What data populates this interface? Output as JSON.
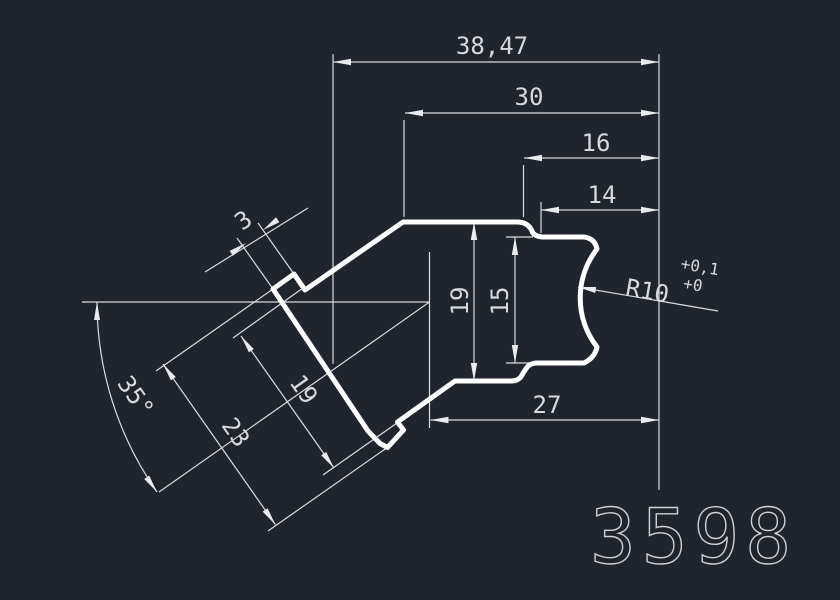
{
  "drawing": {
    "part_number": "3598",
    "dimensions": {
      "overall_width": "38,47",
      "upper_width": "30",
      "step_width_16": "16",
      "step_width_14": "14",
      "lower_width": "27",
      "height_total": "19",
      "height_inner": "15",
      "arm_length_19": "19",
      "arm_length_23": "23",
      "tab_width": "3",
      "arm_angle": "35°",
      "radius": "R10",
      "radius_tol_upper": "+0,1",
      "radius_tol_lower": "+0"
    },
    "colors": {
      "background": "#20242c",
      "outline": "#ffffff",
      "annotation": "#d6dade"
    }
  }
}
